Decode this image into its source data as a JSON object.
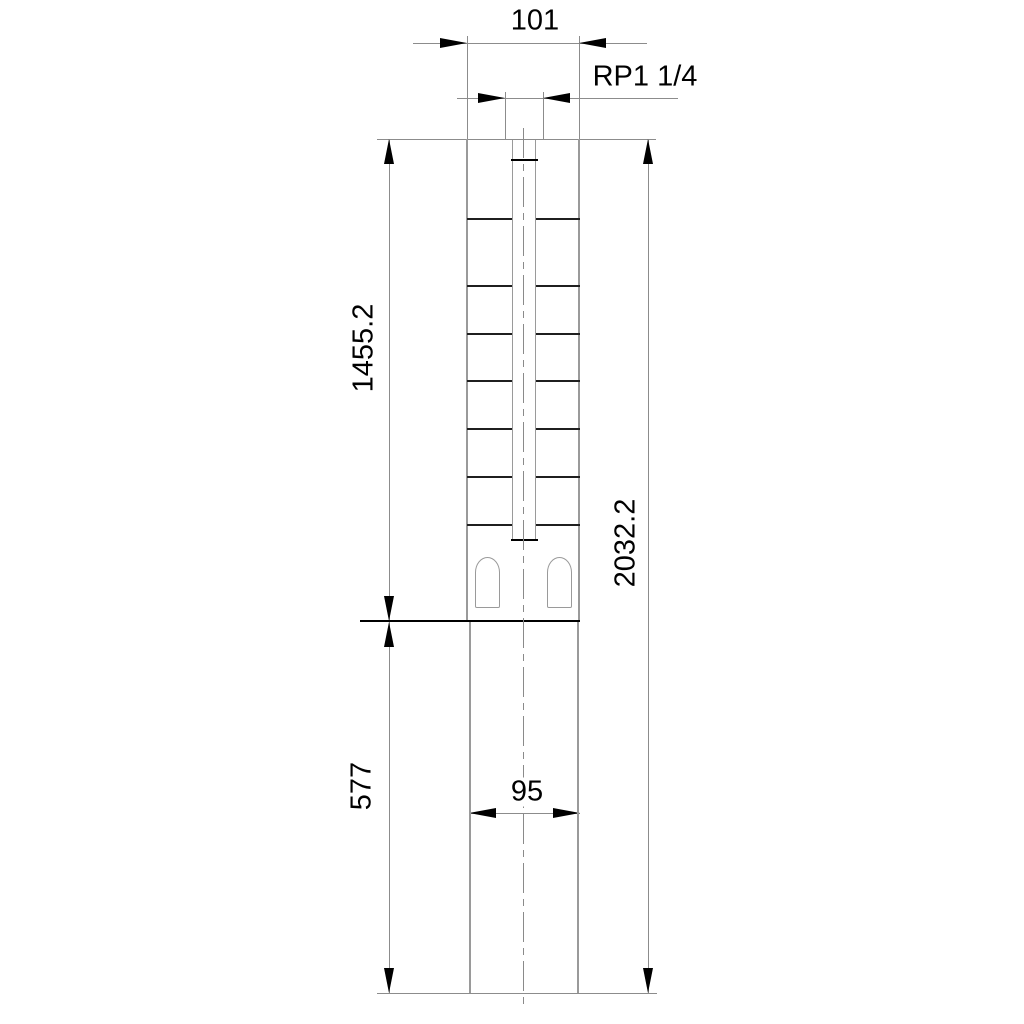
{
  "drawing": {
    "type": "technical-dimension-drawing",
    "subject": "submersible-borehole-pump-outline",
    "labels": {
      "width_top": "101",
      "thread": "RP1 1/4",
      "pump_length": "1455.2",
      "motor_length": "577",
      "total_length": "2032.2",
      "motor_width": "95"
    },
    "colors": {
      "background": "#ffffff",
      "dim_line": "#8c8c8c",
      "body_edge": "#9a9a9a",
      "stage_line": "#1f1f1f",
      "accent_black": "#000000"
    }
  }
}
